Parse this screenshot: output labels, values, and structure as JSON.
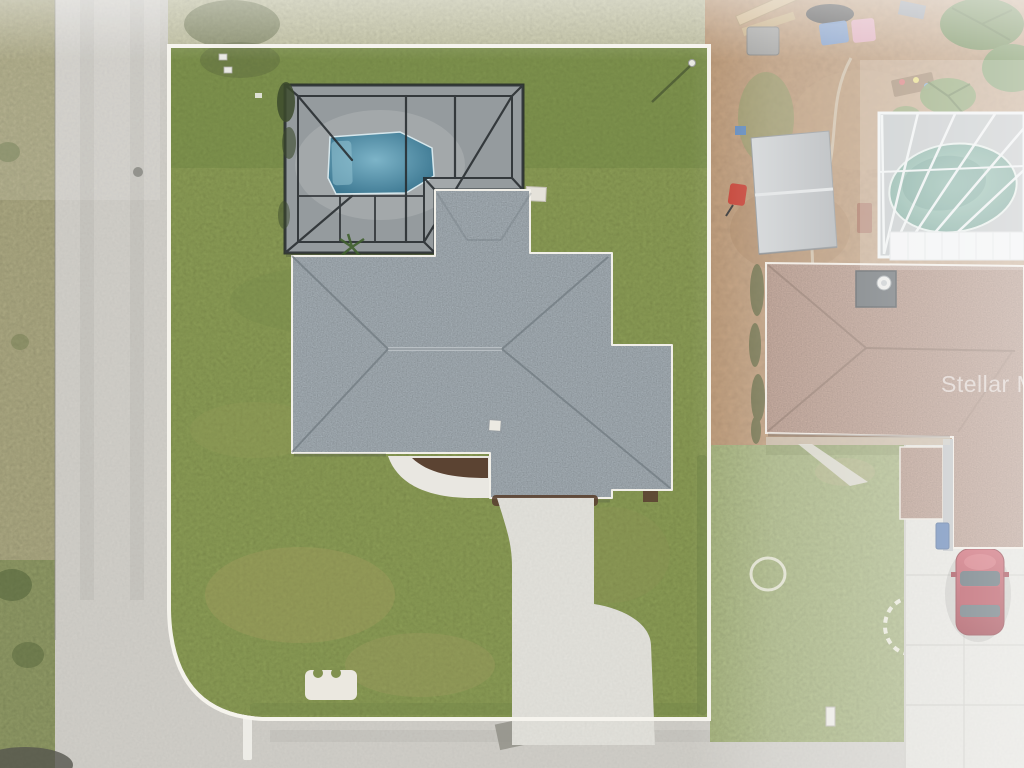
{
  "watermark": {
    "text": "Stellar MLS"
  },
  "palette": {
    "lawn": "#81914f",
    "lawn_top_haze": "#b7b79a",
    "lawn_neighbor": "#9aa773",
    "shoulder": "#9f9c78",
    "street": "#cbc9c3",
    "driveway": "#dddcd6",
    "walkway": "#e9e7e1",
    "boundary_line": "#f7f5ee",
    "roof_main": "#97a0a6",
    "roof_neighbor": "#a8897a",
    "pool_deck": "#a7acae",
    "neighbor_pool_deck": "#b4b9bb",
    "cage_frame": "#24292c",
    "pool_water": "#4b87a0",
    "neighbor_pool_water": "#5f9a8a",
    "dirt_yard": "#b2906f",
    "mulch": "#5b4332",
    "car": "#a62c3a",
    "stone_ring": "#eceadf",
    "shed_roof": "#c0c3c5"
  },
  "scene": {
    "description": "Aerial drone view of a single-family home on a corner lot outlined in white: gray shingle hip roof, dark screened pool enclosure with blue pool, curved concrete driveway to the street; neighboring property at right with brown hip roof, white screened oval pool, metal shed roof, dirt yard and red car.",
    "objects": [
      "main-house-roof",
      "pool-enclosure",
      "swimming-pool",
      "lot-boundary-outline",
      "driveway",
      "front-walkway",
      "street-corner",
      "neighbor-house-roof",
      "neighbor-pool-enclosure",
      "shed-roof",
      "red-car",
      "stone-rings",
      "watermark"
    ]
  }
}
